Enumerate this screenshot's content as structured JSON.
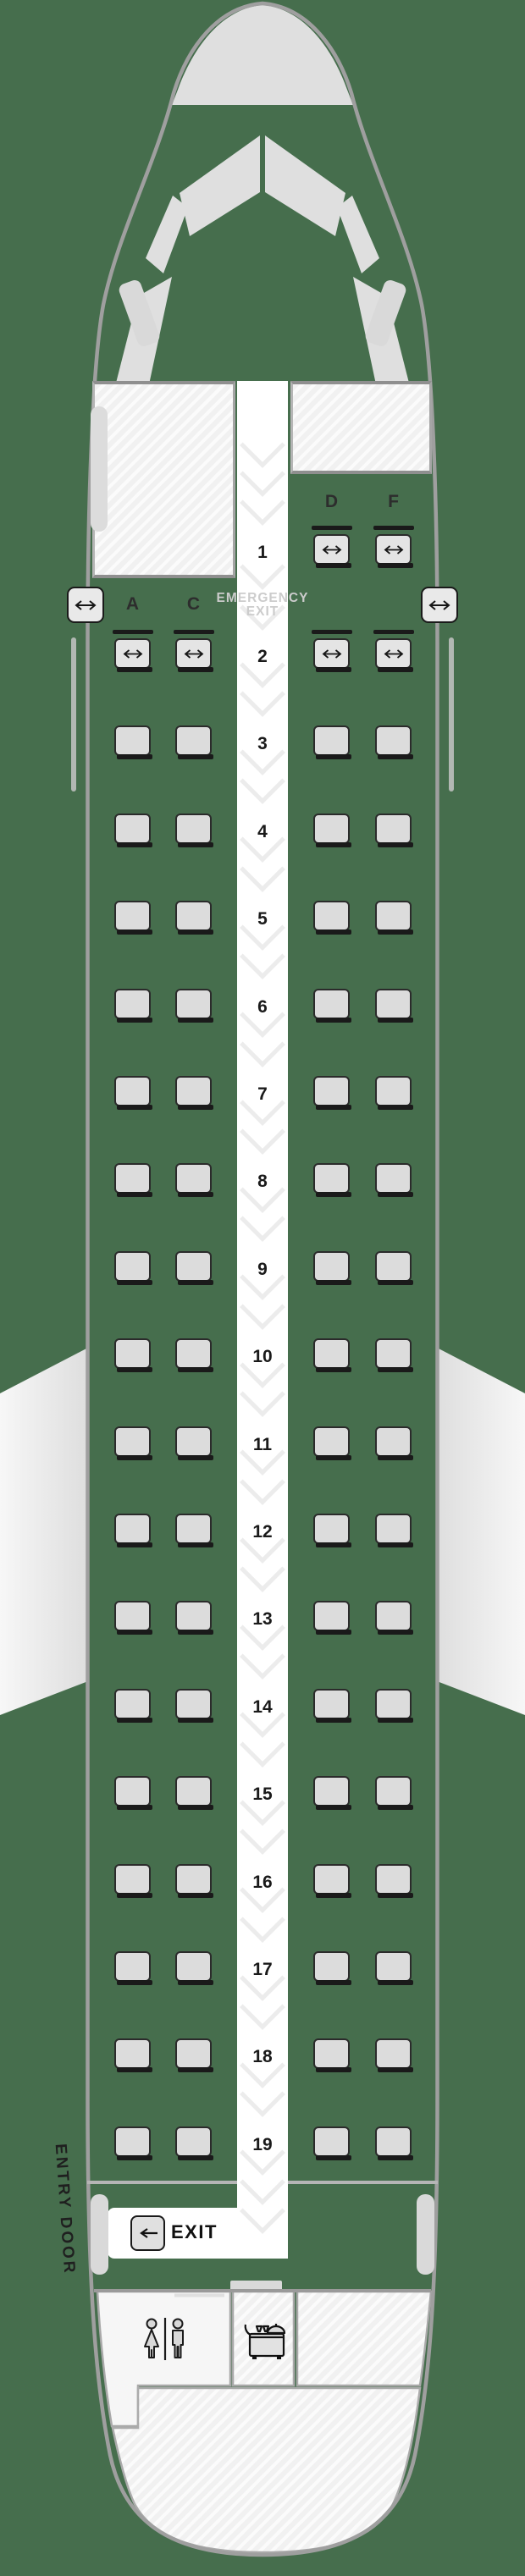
{
  "seat_map": {
    "columns": {
      "left": [
        "A",
        "C"
      ],
      "right": [
        "D",
        "F"
      ]
    },
    "rows": [
      {
        "number": "1",
        "seats": [
          "D",
          "F"
        ],
        "extra_legroom": true,
        "bulkhead_in_front": true
      },
      {
        "number": "2",
        "seats": [
          "A",
          "C",
          "D",
          "F"
        ],
        "extra_legroom": true,
        "bulkhead_in_front": true,
        "emergency_exit_row": true
      },
      {
        "number": "3",
        "seats": [
          "A",
          "C",
          "D",
          "F"
        ]
      },
      {
        "number": "4",
        "seats": [
          "A",
          "C",
          "D",
          "F"
        ]
      },
      {
        "number": "5",
        "seats": [
          "A",
          "C",
          "D",
          "F"
        ]
      },
      {
        "number": "6",
        "seats": [
          "A",
          "C",
          "D",
          "F"
        ]
      },
      {
        "number": "7",
        "seats": [
          "A",
          "C",
          "D",
          "F"
        ]
      },
      {
        "number": "8",
        "seats": [
          "A",
          "C",
          "D",
          "F"
        ]
      },
      {
        "number": "9",
        "seats": [
          "A",
          "C",
          "D",
          "F"
        ]
      },
      {
        "number": "10",
        "seats": [
          "A",
          "C",
          "D",
          "F"
        ]
      },
      {
        "number": "11",
        "seats": [
          "A",
          "C",
          "D",
          "F"
        ]
      },
      {
        "number": "12",
        "seats": [
          "A",
          "C",
          "D",
          "F"
        ]
      },
      {
        "number": "13",
        "seats": [
          "A",
          "C",
          "D",
          "F"
        ]
      },
      {
        "number": "14",
        "seats": [
          "A",
          "C",
          "D",
          "F"
        ]
      },
      {
        "number": "15",
        "seats": [
          "A",
          "C",
          "D",
          "F"
        ]
      },
      {
        "number": "16",
        "seats": [
          "A",
          "C",
          "D",
          "F"
        ]
      },
      {
        "number": "17",
        "seats": [
          "A",
          "C",
          "D",
          "F"
        ]
      },
      {
        "number": "18",
        "seats": [
          "A",
          "C",
          "D",
          "F"
        ]
      },
      {
        "number": "19",
        "seats": [
          "A",
          "C",
          "D",
          "F"
        ]
      }
    ]
  },
  "labels": {
    "emergency_exit_line1": "EMERGENCY",
    "emergency_exit_line2": "EXIT",
    "rear_exit": "EXIT",
    "entry_door": "ENTRY DOOR"
  },
  "icons": {
    "seat_extra_legroom": "double-arrow-icon",
    "emergency_exit_marker": "double-arrow-icon",
    "rear_exit_arrow": "left-arrow-icon",
    "lavatory": "lavatory-icon",
    "galley": "galley-cart-icon"
  },
  "colors": {
    "background_green": "#466E4D",
    "fuselage_outline_gray": "#9F9F9F",
    "cockpit_window_gray": "#DFDFDF",
    "seat_fill": "#DCDCDC",
    "seat_border": "#2B2B2B",
    "seat_base_black": "#1A1A1A",
    "aisle_white": "#FFFFFF",
    "aisle_chevron_gray": "#ECECEC",
    "hatched_area_gray": "#F1F1F1",
    "wing_gray": "#EDEDED",
    "emergency_text_gray": "#CCCCCC"
  }
}
